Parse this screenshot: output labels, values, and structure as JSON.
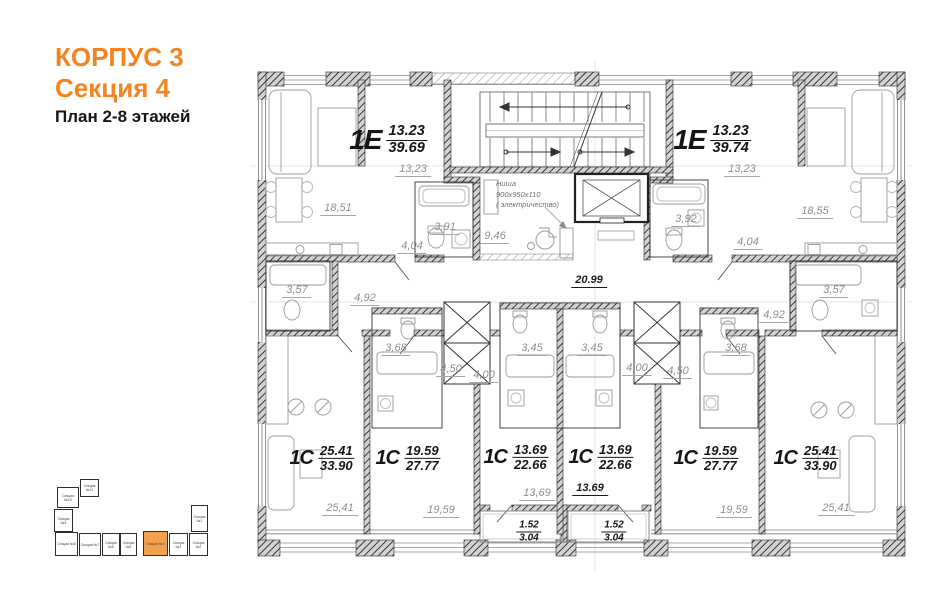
{
  "title": {
    "building": "КОРПУС 3",
    "section": "Секция 4",
    "floors": "План 2-8 этажей"
  },
  "colors": {
    "accent": "#F5831F",
    "minimap_highlight": "#F2A24E"
  },
  "plan": {
    "apartments": [
      {
        "type": "1Е",
        "living": "13.23",
        "total": "39.69"
      },
      {
        "type": "1Е",
        "living": "13.23",
        "total": "39.74"
      },
      {
        "type": "1С",
        "living": "25.41",
        "total": "33.90"
      },
      {
        "type": "1С",
        "living": "19.59",
        "total": "27.77"
      },
      {
        "type": "1С",
        "living": "13.69",
        "total": "22.66"
      },
      {
        "type": "1С",
        "living": "13.69",
        "total": "22.66"
      },
      {
        "type": "1С",
        "living": "19.59",
        "total": "27.77"
      },
      {
        "type": "1С",
        "living": "25.41",
        "total": "33.90"
      }
    ],
    "measurements": {
      "left_living": "13,23",
      "left_room": "18,51",
      "left_bath": "3,91",
      "left_hall": "4,04",
      "left_lobby": "9,46",
      "right_living": "13,23",
      "right_room": "18,55",
      "right_bath": "3,92",
      "right_hall": "4,04",
      "corridor": "20.99",
      "a1_bath": "3,57",
      "a1_hall": "4,92",
      "a2_bath": "3,68",
      "a2_hall": "4,50",
      "a3_hall": "4,00",
      "a3_bath": "3,45",
      "a4_bath": "3,45",
      "a4_hall": "4,00",
      "a5_hall": "4,50",
      "a5_bath": "3,68",
      "a6_hall": "4,92",
      "a6_bath": "3,57",
      "a1_room": "25,41",
      "a2_room": "19,59",
      "a3_room": "13,69",
      "a4_room": "13.69",
      "a5_room": "19,59",
      "a6_room": "25,41"
    },
    "niche": {
      "line1": "Ниша",
      "line2": "900х950х110",
      "line3": "( электричество)"
    },
    "balconies": [
      {
        "reduced": "1.52",
        "full": "3.04"
      },
      {
        "reduced": "1.52",
        "full": "3.04"
      }
    ]
  },
  "minimap": {
    "sections": [
      "Секция №11",
      "Секция №10",
      "Секция №9",
      "Секция №8",
      "Секция №7",
      "Секция №6",
      "Секция №5",
      "Секция №4",
      "Секция №3",
      "Секция №2",
      "Секция №1"
    ]
  }
}
